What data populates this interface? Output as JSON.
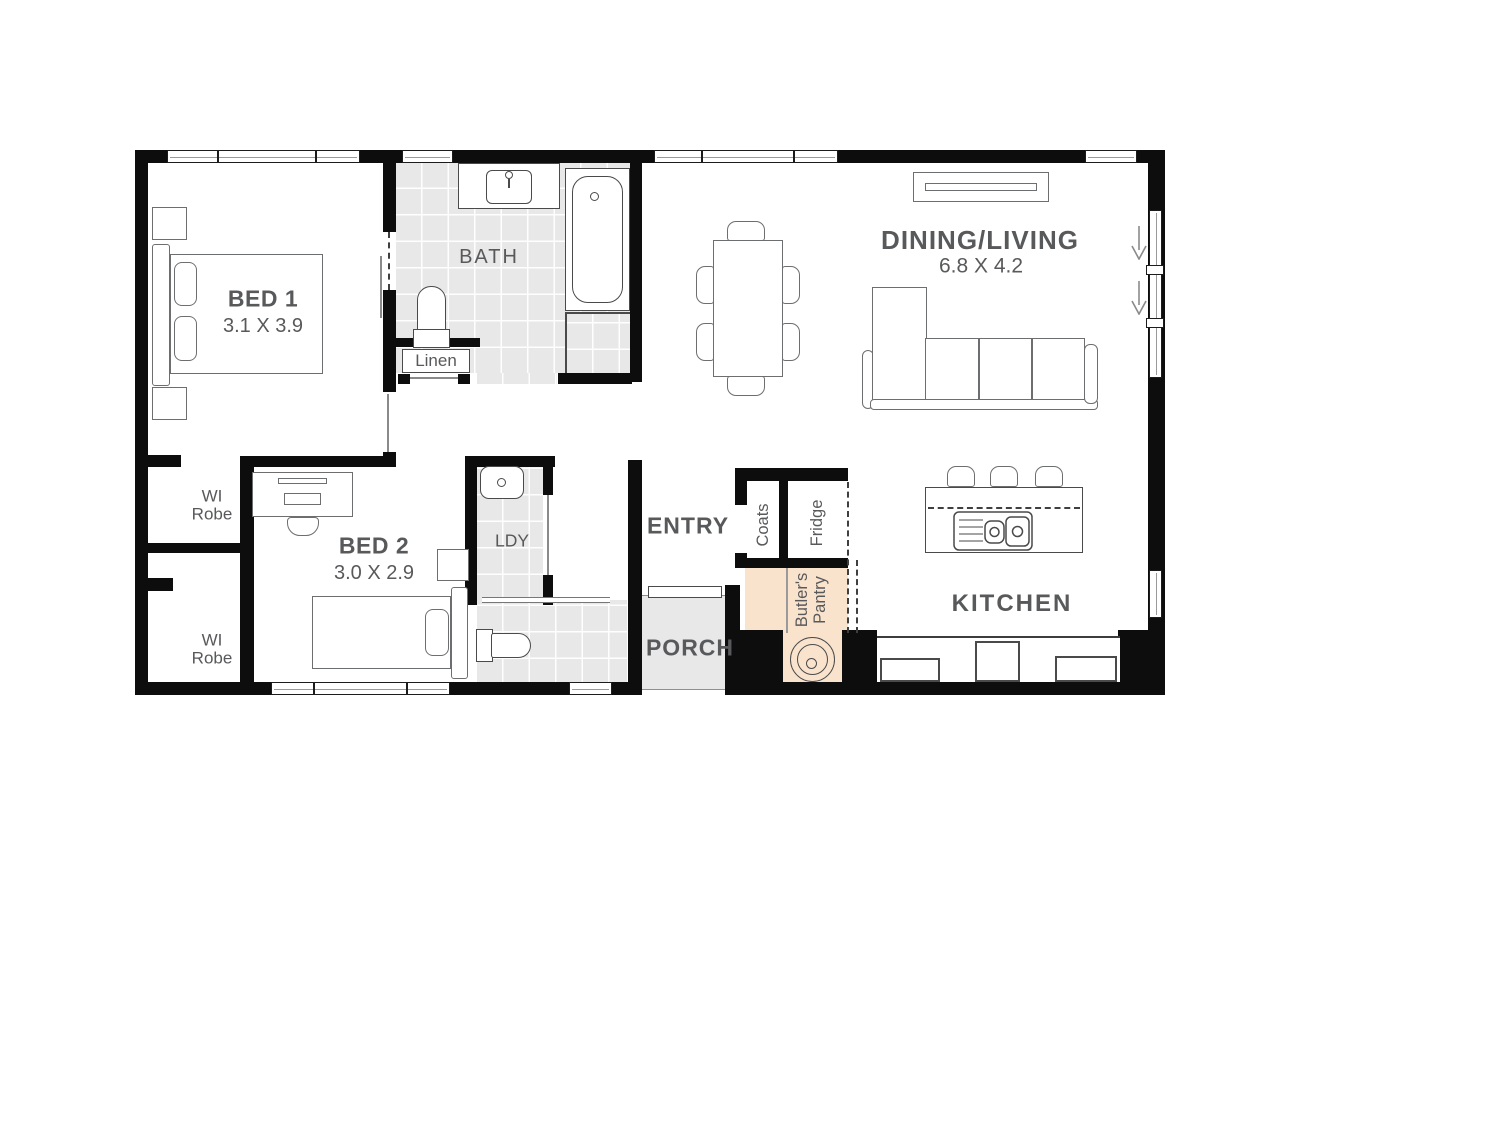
{
  "plan_title": "floor-plan",
  "colors": {
    "wall": "#0d0d0d",
    "tile": "#e8e8e8",
    "pantry": "#fae3cd",
    "label": "#58595b",
    "line": "#6d6e70"
  },
  "rooms": {
    "bed1": {
      "name": "BED 1",
      "dims": "3.1 X 3.9"
    },
    "bed2": {
      "name": "BED 2",
      "dims": "3.0 X 2.9"
    },
    "bath": {
      "name": "BATH"
    },
    "linen": {
      "name": "Linen"
    },
    "dining_living": {
      "name": "DINING/LIVING",
      "dims": "6.8 X 4.2"
    },
    "wi_robe_1": {
      "line1": "WI",
      "line2": "Robe"
    },
    "wi_robe_2": {
      "line1": "WI",
      "line2": "Robe"
    },
    "ldy": {
      "name": "LDY"
    },
    "entry": {
      "name": "ENTRY"
    },
    "porch": {
      "name": "PORCH"
    },
    "coats": {
      "name": "Coats"
    },
    "fridge": {
      "name": "Fridge"
    },
    "butlers_pantry": {
      "line1": "Butler's",
      "line2": "Pantry"
    },
    "kitchen": {
      "name": "KITCHEN"
    }
  }
}
